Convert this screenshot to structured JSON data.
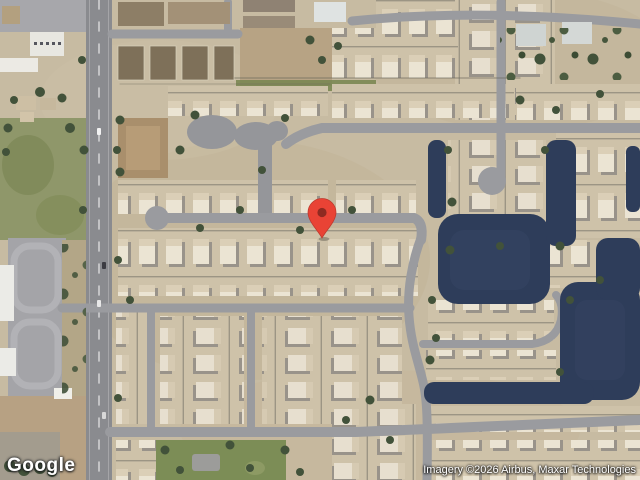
{
  "map": {
    "view_type": "satellite",
    "logo_text": "Google",
    "attribution_text": "Imagery ©2026 Airbus, Maxar Technologies",
    "marker": {
      "label": "location-marker",
      "pin_color": "#E94335",
      "pin_inner_color": "#8F2A21"
    },
    "palette": {
      "water": "#2e3d5a",
      "road": "#9a9b9f",
      "arterial_road": "#8a8b8f",
      "desert": "#c7bba2",
      "grass": "#8f976a",
      "tree": "#42523a"
    }
  }
}
